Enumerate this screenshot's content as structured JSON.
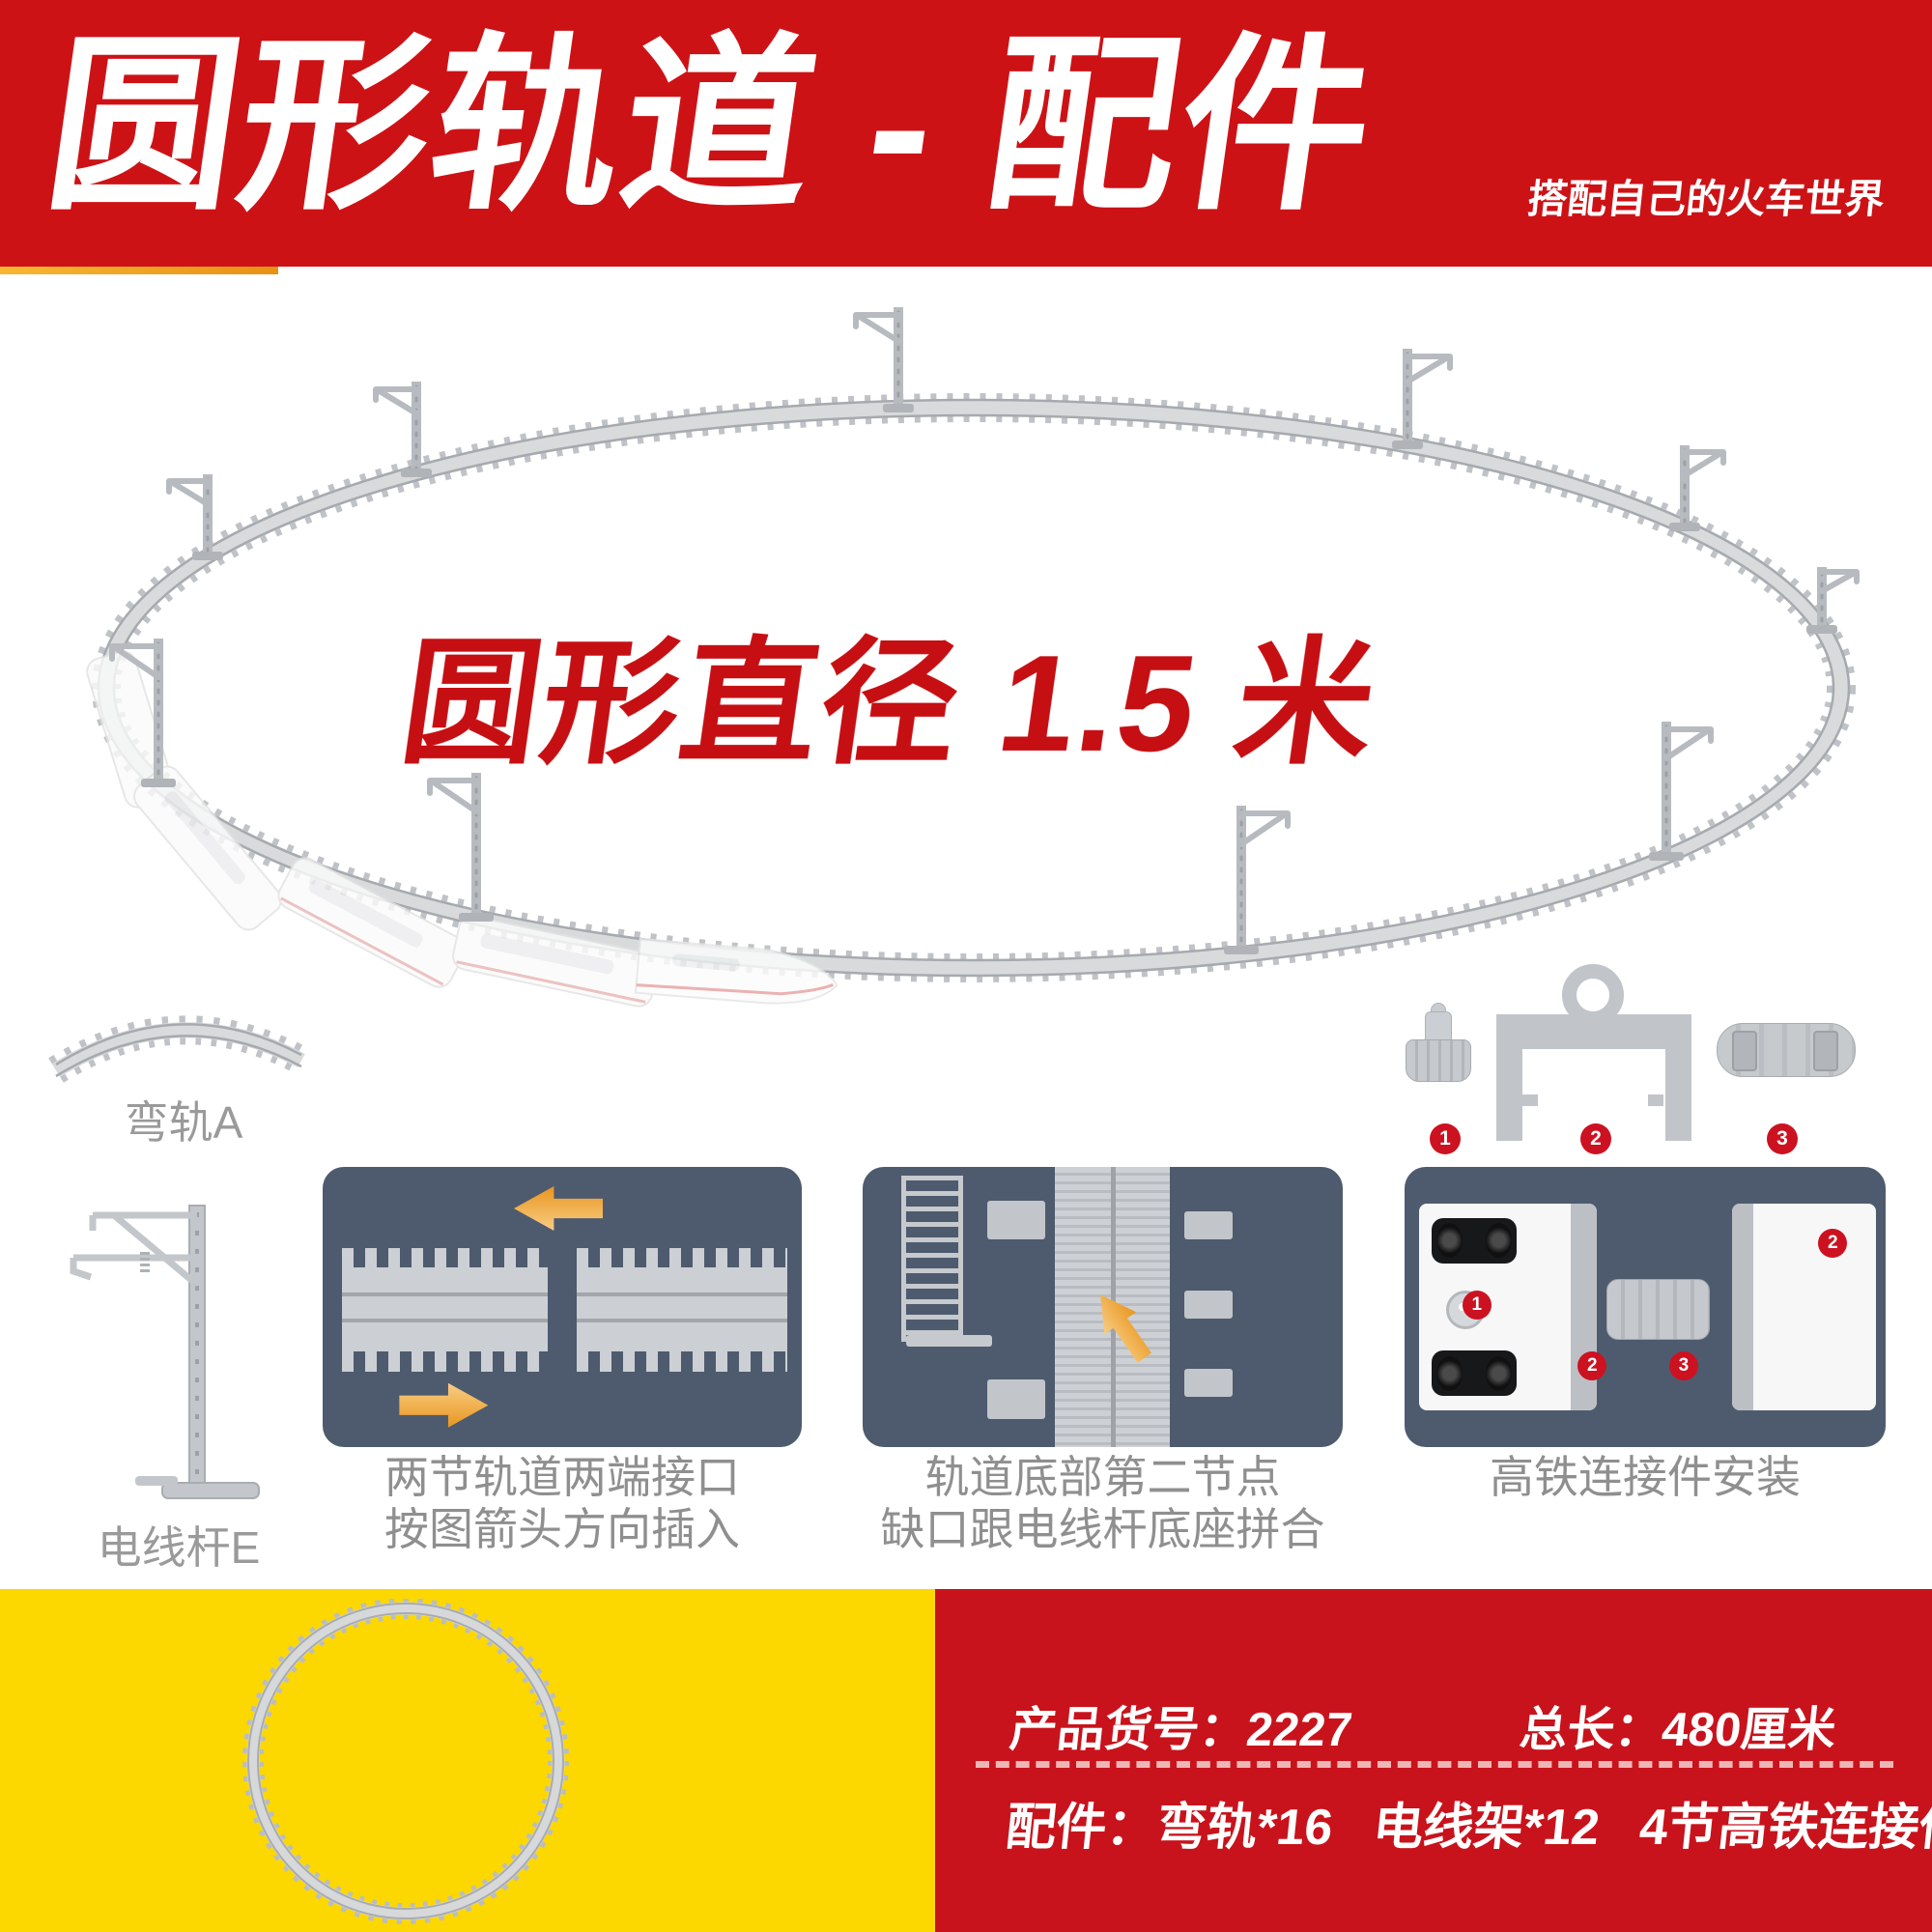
{
  "banner": {
    "title": "圆形轨道 - 配件",
    "tagline": "搭配自己的火车世界"
  },
  "hero": {
    "headline": "圆形直径 1.5 米"
  },
  "parts_left": {
    "curved_track_label": "弯轨A",
    "pole_label": "电线杆E"
  },
  "connector_parts": {
    "badges": [
      "1",
      "2",
      "3"
    ]
  },
  "panels": [
    {
      "caption_line1": "两节轨道两端接口",
      "caption_line2": "按图箭头方向插入"
    },
    {
      "caption_line1": "轨道底部第二节点",
      "caption_line2": "缺口跟电线杆底座拼合"
    },
    {
      "caption_line1": "高铁连接件安装",
      "badges": [
        "1",
        "2",
        "2",
        "3"
      ]
    }
  ],
  "footer": {
    "sku_label": "产品货号：",
    "sku_value": "2227",
    "length_label": "总长：",
    "length_value": "480厘米",
    "accessories_label": "配件：",
    "accessories": [
      "弯轨*16",
      "电线架*12",
      "4节高铁连接件"
    ]
  },
  "colors": {
    "banner_red": "#cd1216",
    "footer_red": "#c8131c",
    "yellow": "#fcd700",
    "panel_slate": "#4e5b6e",
    "badge_red": "#cc1220",
    "arrow_orange": "#e9961f",
    "headline_red": "#c60f13",
    "caption_gray": "#8f8f8f"
  }
}
